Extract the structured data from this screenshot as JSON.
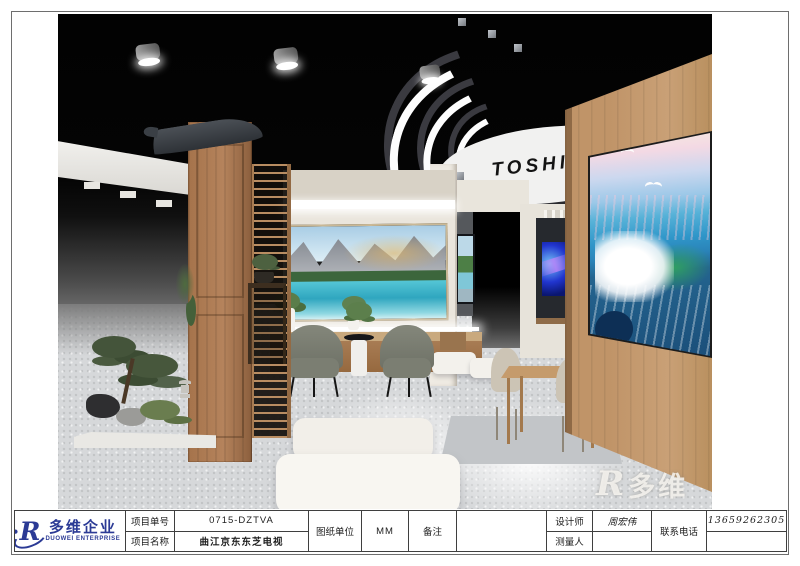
{
  "sheet": {
    "logo": {
      "mark": "R",
      "cn": "多维企业",
      "en": "DUOWEI ENTERPRISE"
    },
    "watermark": {
      "mark": "R",
      "cn": "多维"
    },
    "title_block": {
      "project_no_label": "项目单号",
      "project_no": "0715-DZTVA",
      "project_name_label": "项目名称",
      "project_name": "曲江京东东芝电视",
      "unit_label": "图纸单位",
      "unit": "MM",
      "remark_label": "备注",
      "remark": "",
      "designer_label": "设计师",
      "designer": "周宏伟",
      "surveyor_label": "测量人",
      "surveyor": "",
      "phone_label": "联系电话",
      "phone": "13659262305"
    }
  },
  "scene": {
    "brand_sign": "TOSHIBA",
    "description": "3D rendering of a Toshiba TV showroom booth",
    "colors": {
      "ceiling": "#040404",
      "floor": "#d6d8da",
      "wood_dark": "#a5734b",
      "wood_light": "#c09468",
      "wall_cream": "#eae5dc",
      "chair_gray": "#7b7e72",
      "logo_blue": "#2b3a95"
    }
  }
}
